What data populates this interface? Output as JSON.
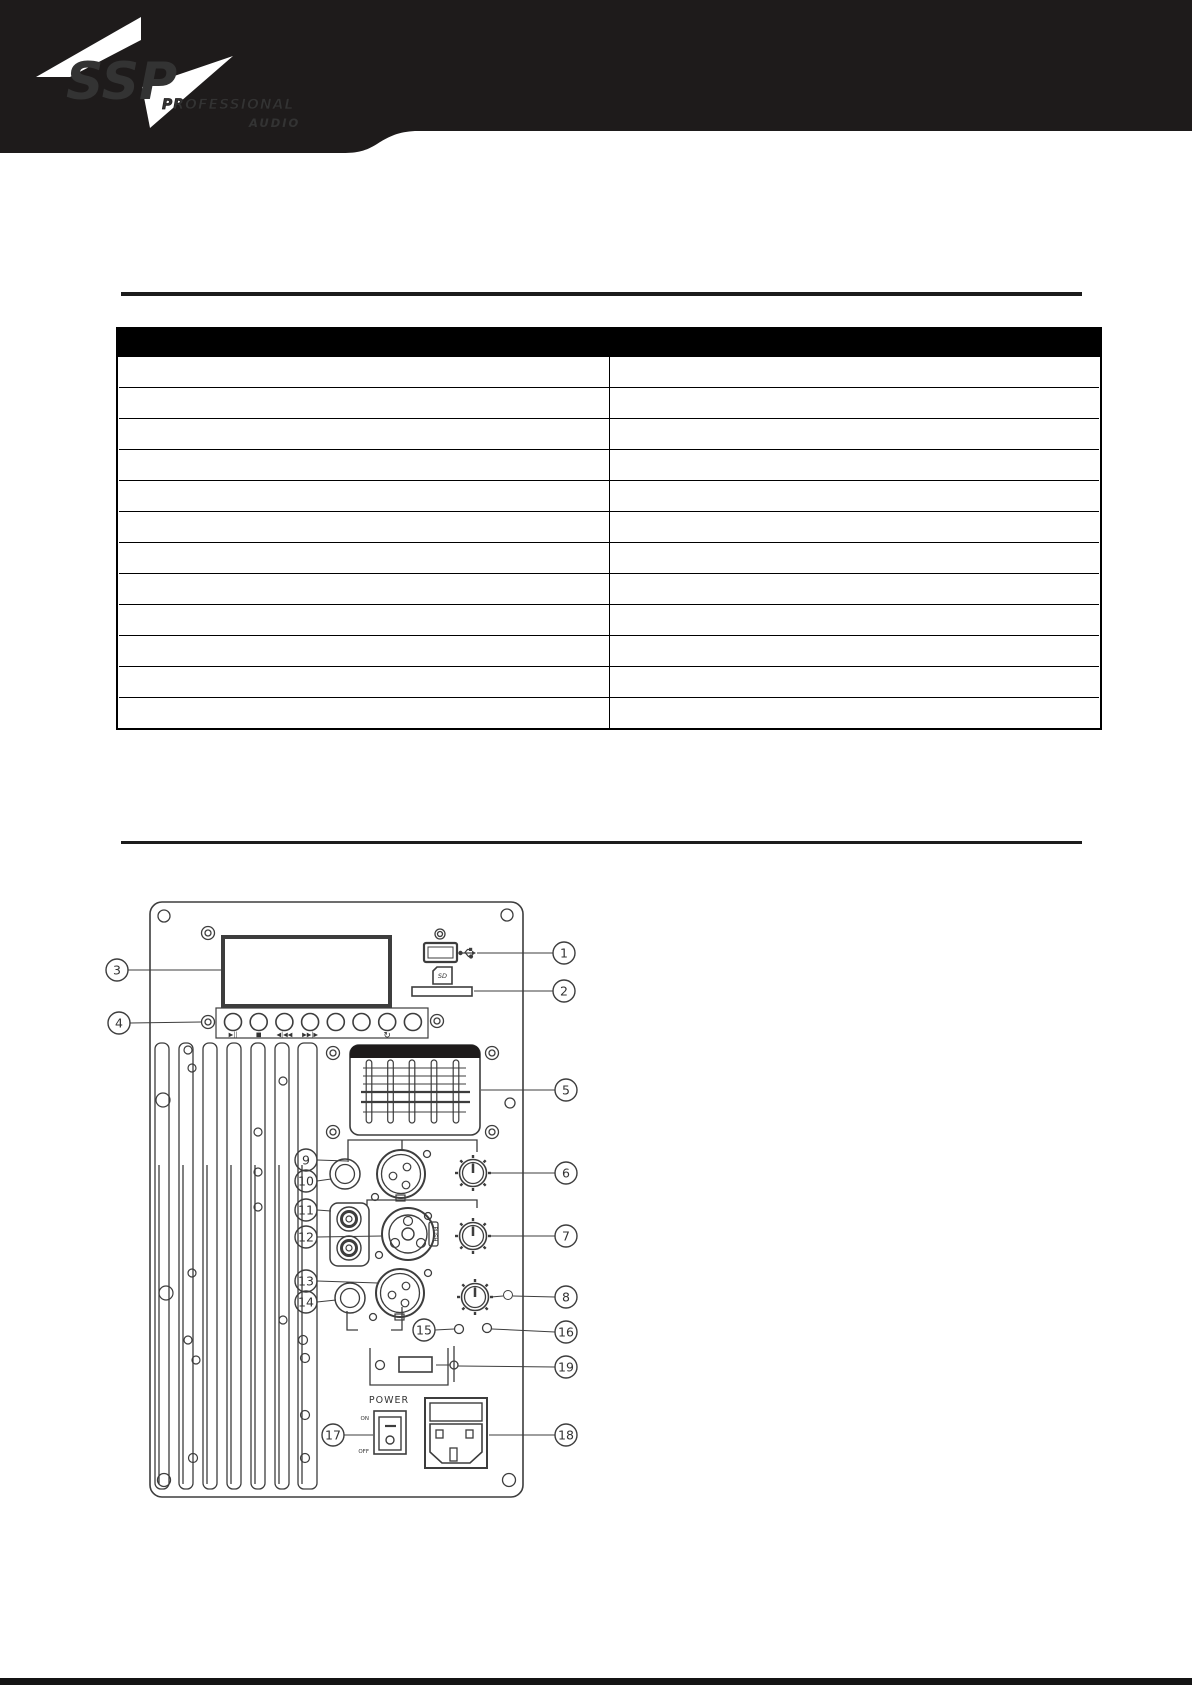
{
  "header": {
    "logo_main": "SSP",
    "logo_sub1": "PROFESSIONAL",
    "logo_sub2": "AUDIO"
  },
  "table": {
    "rows": [
      {
        "col1": "",
        "col2": ""
      },
      {
        "col1": "",
        "col2": ""
      },
      {
        "col1": "",
        "col2": ""
      },
      {
        "col1": "",
        "col2": ""
      },
      {
        "col1": "",
        "col2": ""
      },
      {
        "col1": "",
        "col2": ""
      },
      {
        "col1": "",
        "col2": ""
      },
      {
        "col1": "",
        "col2": ""
      },
      {
        "col1": "",
        "col2": ""
      },
      {
        "col1": "",
        "col2": ""
      },
      {
        "col1": "",
        "col2": ""
      },
      {
        "col1": "",
        "col2": ""
      }
    ]
  },
  "diagram": {
    "callouts": {
      "c1": "1",
      "c2": "2",
      "c3": "3",
      "c4": "4",
      "c5": "5",
      "c6": "6",
      "c7": "7",
      "c8": "8",
      "c9": "9",
      "c10": "10",
      "c11": "11",
      "c12": "12",
      "c13": "13",
      "c14": "14",
      "c15": "15",
      "c16": "16",
      "c17": "17",
      "c18": "18",
      "c19": "19"
    },
    "labels": {
      "power": "POWER",
      "on": "ON",
      "off": "OFF",
      "push": "PUSH",
      "sd_icon": "SD"
    },
    "button_captions": {
      "play_pause": "▶||",
      "stop": "■",
      "prev": "◀|◀◀",
      "next": "▶▶|▶",
      "repeat": "↻"
    }
  }
}
